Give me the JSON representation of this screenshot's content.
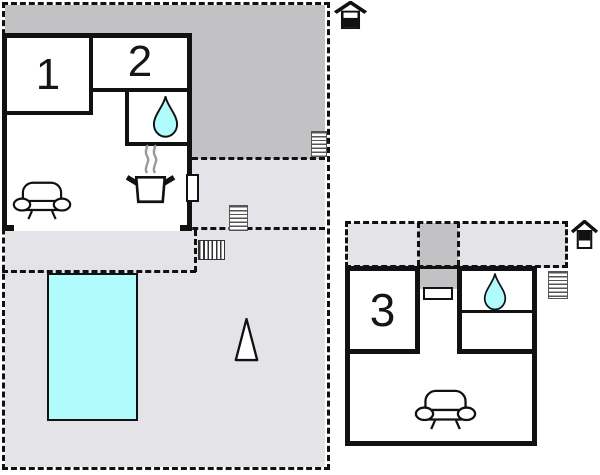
{
  "colors": {
    "background": "#ffffff",
    "wall": "#111111",
    "interior": "#ffffff",
    "terrace_light": "#e4e4e8",
    "terrace_dark": "#c2c2c5",
    "water": "#b0fcfc",
    "steam": "#999999"
  },
  "plans": {
    "ground": {
      "rooms": [
        {
          "label": "1"
        },
        {
          "label": "2"
        }
      ]
    },
    "upper": {
      "rooms": [
        {
          "label": "3"
        }
      ]
    }
  }
}
